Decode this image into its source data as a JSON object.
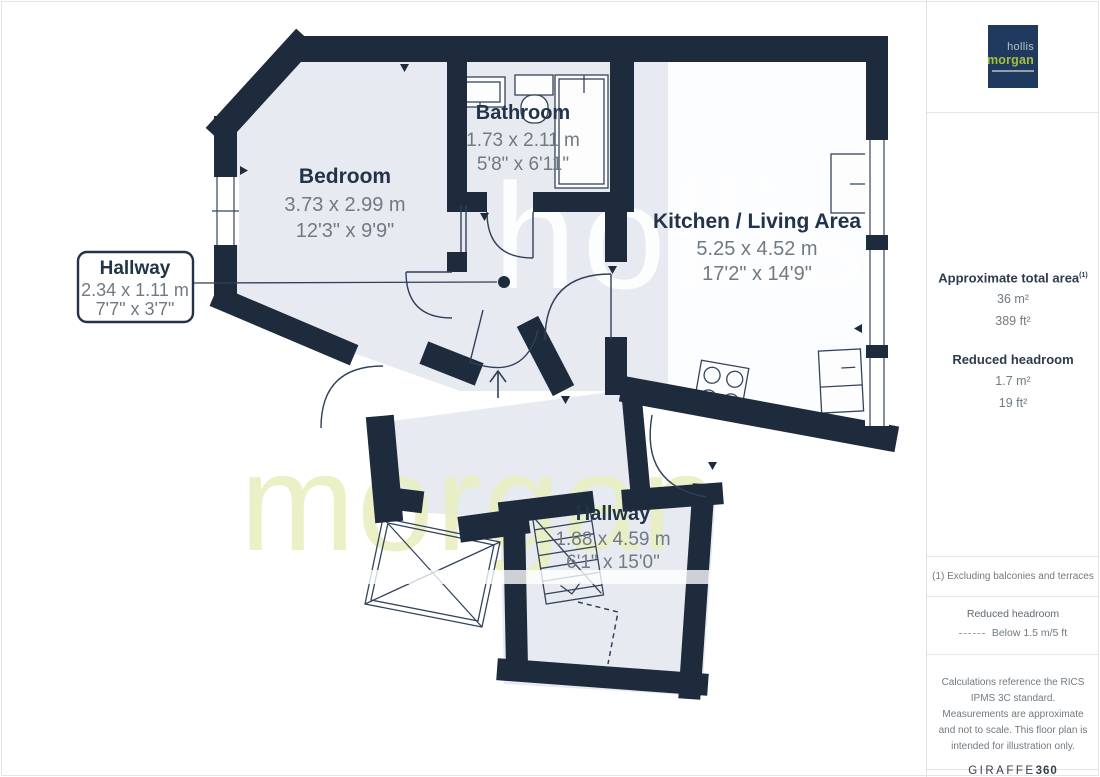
{
  "branding": {
    "logo_top": "hollis",
    "logo_bottom": "morgan",
    "watermark_top": "hollis",
    "watermark_bottom": "morgan"
  },
  "panel": {
    "area_heading": "Approximate total area",
    "area_note_sup": "(1)",
    "area_m2": "36 m²",
    "area_ft2": "389 ft²",
    "reduced_heading": "Reduced headroom",
    "reduced_m2": "1.7 m²",
    "reduced_ft2": "19 ft²",
    "note": "(1) Excluding balconies and terraces",
    "legend_title": "Reduced headroom",
    "legend_value": "Below 1.5 m/5 ft",
    "disclaimer": "Calculations reference the RICS IPMS 3C standard. Measurements are approximate and not to scale. This floor plan is intended for illustration only.",
    "brand_word": "GIRAFFE",
    "brand_num": "360"
  },
  "rooms": {
    "bedroom": {
      "name": "Bedroom",
      "metric": "3.73 x 2.99 m",
      "imperial": "12'3\" x 9'9\""
    },
    "bathroom": {
      "name": "Bathroom",
      "metric": "1.73 x 2.11 m",
      "imperial": "5'8\" x 6'11\""
    },
    "kitchen": {
      "name": "Kitchen / Living Area",
      "metric": "5.25 x 4.52 m",
      "imperial": "17'2\" x 14'9\""
    },
    "hallway_small": {
      "name": "Hallway",
      "metric": "2.34 x 1.11 m",
      "imperial": "7'7\" x 3'7\""
    },
    "hallway_main": {
      "name": "Hallway",
      "metric": "1.88 x 4.59 m",
      "imperial": "6'1\" x 15'0\""
    }
  },
  "colors": {
    "wall": "#1e2b3d",
    "floor": "#e7ebf1",
    "logo_navy": "#1f3a5e",
    "brand_green": "#a3c13c",
    "watermark_green": "#e9efbf",
    "dim_text": "#707a82",
    "name_text": "#22334a"
  }
}
